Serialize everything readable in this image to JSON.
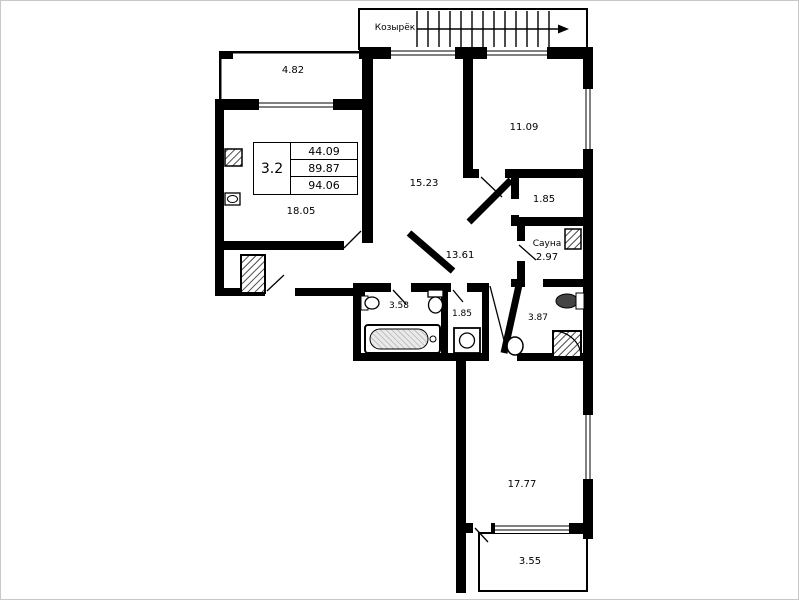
{
  "plan": {
    "canopy_label": "Козырёк",
    "unit_card": {
      "type": "3.2",
      "living_area": "44.09",
      "area": "89.87",
      "total_area": "94.06"
    }
  },
  "rooms": {
    "balcony_top": {
      "area": "4.82"
    },
    "kitchen": {
      "area": "18.05"
    },
    "bedroom_mid": {
      "area": "15.23"
    },
    "bedroom_right": {
      "area": "11.09"
    },
    "closet": {
      "area": "1.85"
    },
    "sauna": {
      "name": "Сауна",
      "area": "2.97"
    },
    "hall": {
      "area": "13.61"
    },
    "bathroom": {
      "area": "3.58"
    },
    "wc": {
      "area": "1.85"
    },
    "shower_room": {
      "area": "3.87"
    },
    "bedroom_bottom": {
      "area": "17.77"
    },
    "balcony_bottom": {
      "area": "3.55"
    }
  },
  "colors": {
    "wall": "#000000",
    "background": "#ffffff"
  }
}
